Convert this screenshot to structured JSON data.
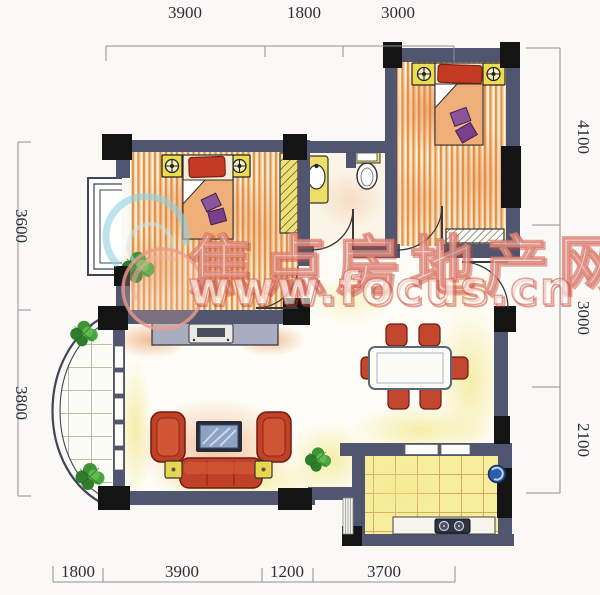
{
  "page": {
    "type": "apartment-floor-plan-scan"
  },
  "watermark": {
    "cn": "焦点房地产网",
    "url": "www.focus.cn"
  },
  "dimensions": {
    "top": [
      {
        "label": "3900"
      },
      {
        "label": "1800"
      },
      {
        "label": "3000"
      }
    ],
    "bottom": [
      {
        "label": "1800"
      },
      {
        "label": "3900"
      },
      {
        "label": "1200"
      },
      {
        "label": "3700"
      }
    ],
    "left": [
      {
        "label": "3600"
      },
      {
        "label": "3800"
      }
    ],
    "right": [
      {
        "label": "4100"
      },
      {
        "label": "3000"
      },
      {
        "label": "2100"
      }
    ]
  },
  "colors": {
    "background": "#faf9f5",
    "wall": "#515670",
    "column": "#141414",
    "wood_floor": "#de9252",
    "kitchen_tile": "#f7ee9d",
    "furniture_red": "#c04028",
    "nightstand_yellow": "#ecdc50",
    "plant_green": "#3f9437",
    "watermark_red": "#d4604e"
  }
}
